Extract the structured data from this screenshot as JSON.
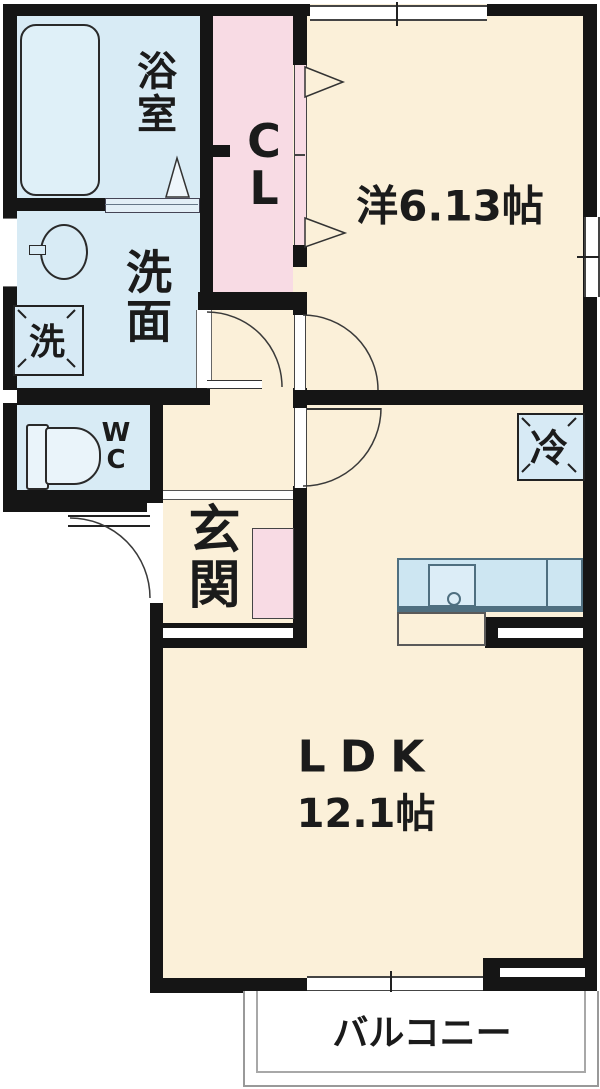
{
  "labels": {
    "bathroom": "浴室",
    "washroom": "洗面",
    "washer": "洗",
    "wc": "WC",
    "closet": "CL",
    "western_room": "洋6.13帖",
    "entrance": "玄関",
    "fridge": "冷",
    "ldk": "LDK",
    "ldk_size": "12.1帖",
    "balcony": "バルコニー"
  },
  "colors": {
    "cream": "#fbf0d9",
    "pink": "#f8dbe4",
    "blue": "#d8ebf5",
    "blue2": "#cde6f2",
    "wall": "#151515",
    "ink": "#1b1b1b",
    "line": "#3a3a3a",
    "white": "#ffffff",
    "balc": "#999999"
  }
}
